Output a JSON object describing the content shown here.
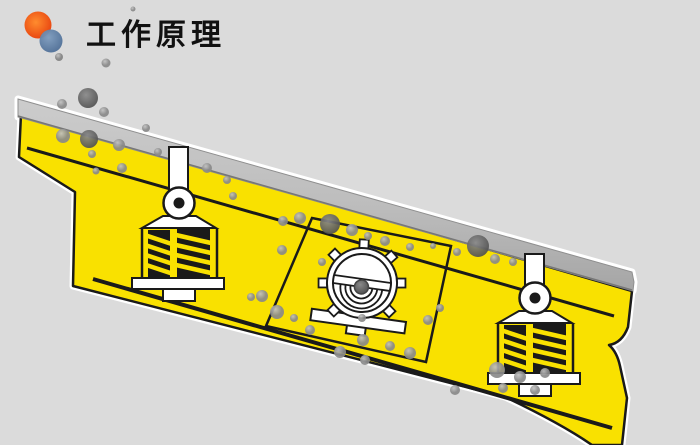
{
  "page": {
    "background": "#DBDBDB",
    "type": "working-principle-animation-frame"
  },
  "header": {
    "title": "工作原理",
    "title_color": "#111111",
    "logo": {
      "orange_circle": "#E8430F",
      "orange_circle_light": "#FF8C2E",
      "blue_circle": "#4E6E96",
      "blue_circle_light": "#7E9CBE",
      "gray_dot": "#9A9A9A"
    }
  },
  "machine": {
    "name": "inclined-vibrating-screen",
    "body_color": "#F9E100",
    "outline_color": "#1A1A1A",
    "halo_color": "#FFFFFF",
    "deck_color_top": "#CCCCCC",
    "deck_color_bottom": "#A5A5A5",
    "deck_edge_color": "#8F8F8F",
    "parts": [
      {
        "name": "feed-deck-strip"
      },
      {
        "name": "screen-surface-line"
      },
      {
        "name": "base-frame-line"
      },
      {
        "name": "left-spring-damper"
      },
      {
        "name": "right-spring-damper"
      },
      {
        "name": "eccentric-vibrator"
      },
      {
        "name": "vibrator-housing-panel"
      },
      {
        "name": "discharge-end"
      }
    ]
  },
  "particles": {
    "description": "gray rock particles on screen deck",
    "fill_light": "#C2C2C2",
    "fill_mid": "#8A8A8A",
    "fill_dark": "#4A4A4A",
    "items": [
      [
        106,
        63,
        4.5
      ],
      [
        133,
        9,
        2.5
      ],
      [
        88,
        98,
        10
      ],
      [
        62,
        104,
        5
      ],
      [
        104,
        112,
        5
      ],
      [
        146,
        128,
        4
      ],
      [
        63,
        136,
        7
      ],
      [
        89,
        139,
        9
      ],
      [
        119,
        145,
        6
      ],
      [
        92,
        154,
        4
      ],
      [
        158,
        152,
        4
      ],
      [
        122,
        168,
        5
      ],
      [
        96,
        171,
        3.5
      ],
      [
        207,
        168,
        5
      ],
      [
        227,
        180,
        4
      ],
      [
        233,
        196,
        4
      ],
      [
        283,
        221,
        5
      ],
      [
        300,
        218,
        6
      ],
      [
        330,
        224,
        10
      ],
      [
        352,
        230,
        6
      ],
      [
        368,
        236,
        4
      ],
      [
        385,
        241,
        5
      ],
      [
        410,
        247,
        4
      ],
      [
        433,
        246,
        3
      ],
      [
        457,
        252,
        4
      ],
      [
        478,
        246,
        11
      ],
      [
        495,
        259,
        5
      ],
      [
        513,
        262,
        4
      ],
      [
        282,
        250,
        5
      ],
      [
        322,
        262,
        4
      ],
      [
        251,
        297,
        4
      ],
      [
        262,
        296,
        6
      ],
      [
        277,
        312,
        7
      ],
      [
        294,
        318,
        4
      ],
      [
        310,
        330,
        5
      ],
      [
        340,
        352,
        6
      ],
      [
        363,
        340,
        6
      ],
      [
        365,
        360,
        5
      ],
      [
        390,
        346,
        5
      ],
      [
        410,
        353,
        6
      ],
      [
        362,
        318,
        4
      ],
      [
        428,
        320,
        5
      ],
      [
        440,
        308,
        4
      ],
      [
        455,
        390,
        5
      ],
      [
        497,
        370,
        8
      ],
      [
        520,
        377,
        6
      ],
      [
        545,
        373,
        5
      ],
      [
        503,
        388,
        5
      ],
      [
        535,
        390,
        5
      ]
    ]
  }
}
